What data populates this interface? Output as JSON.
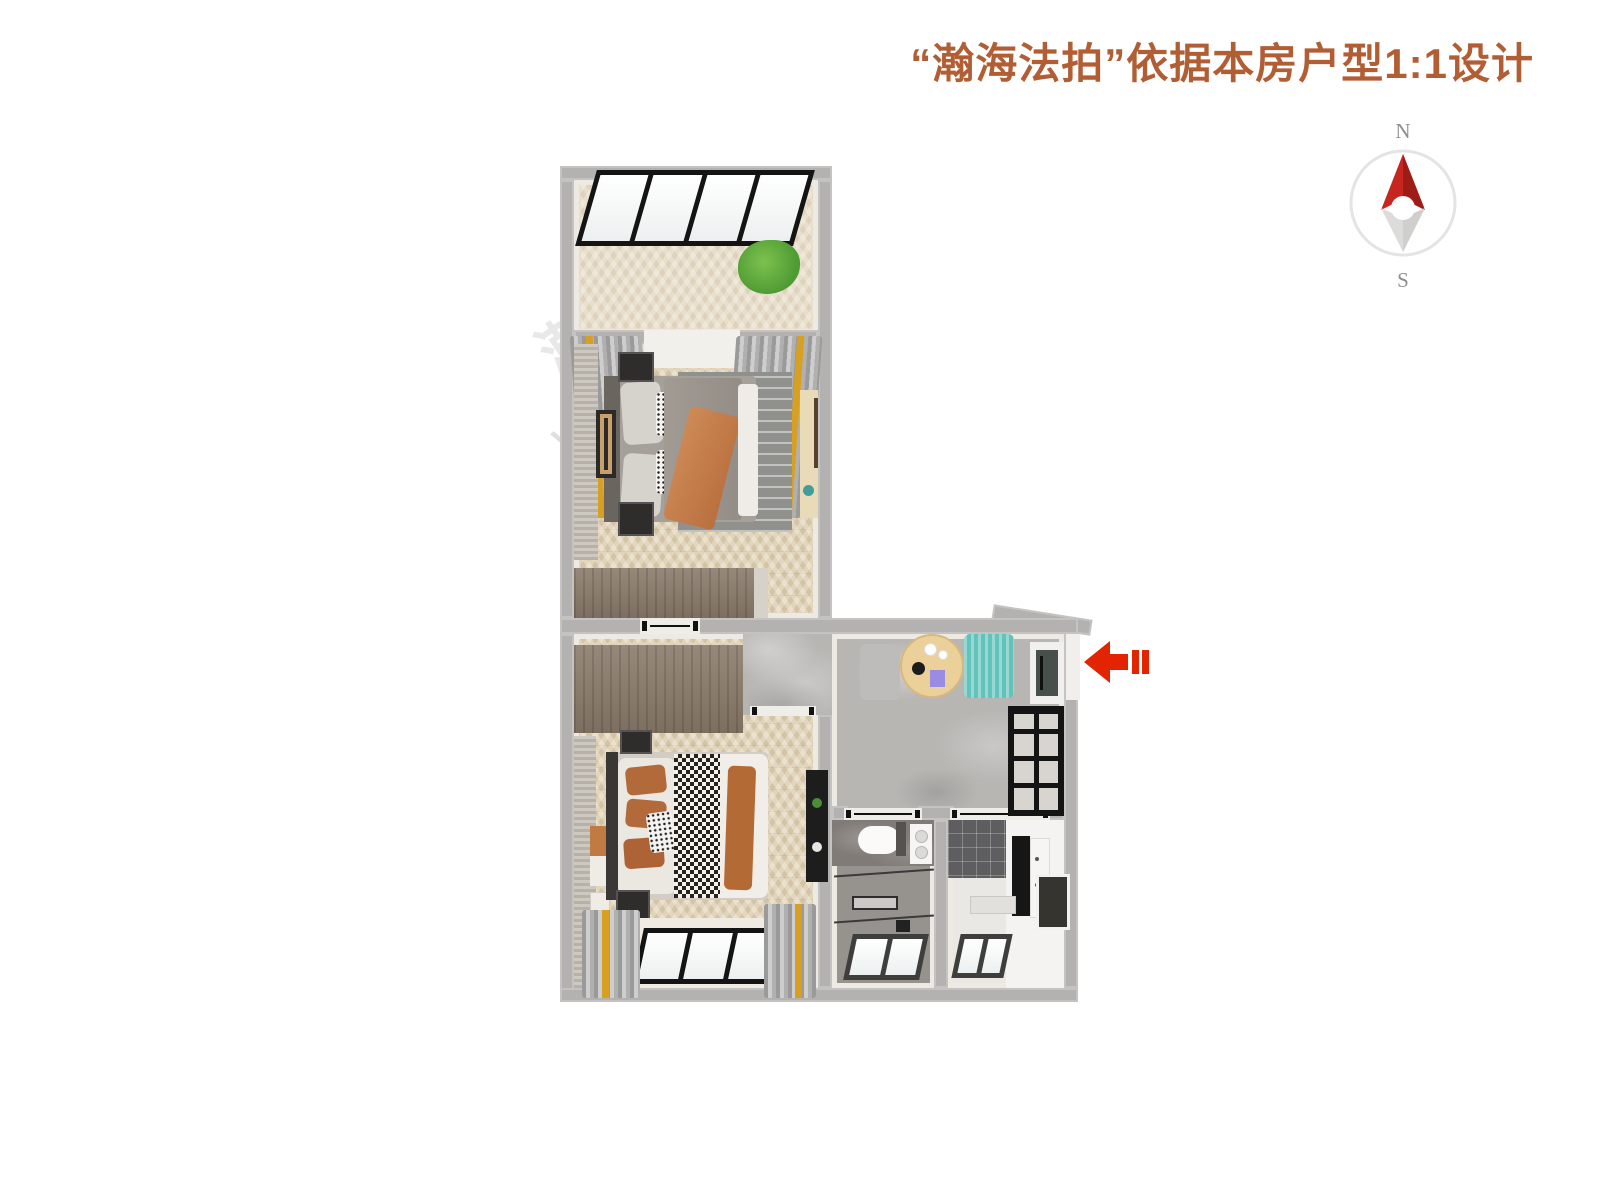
{
  "page": {
    "background": "#ffffff"
  },
  "header": {
    "title": "“瀚海法拍”依据本房户型1:1设计",
    "title_color": "#b25e35"
  },
  "compass": {
    "north_label": "N",
    "south_label": "S",
    "colors": {
      "needle_north": "#c6261f",
      "needle_north_shade": "#9e1b16",
      "needle_south": "#dcdcda",
      "ring": "#e4e4e4",
      "labels": "#8f8f8f"
    }
  },
  "entrance_arrow": {
    "icon": "arrow-left",
    "color": "#e32400"
  },
  "watermarks": {
    "primary": "www.fanai.cn",
    "secondary": "瀚海法拍"
  },
  "floor_plan": {
    "wall_color": "#b4b2b0",
    "rooms": [
      {
        "id": "balcony",
        "floor_color": "#e9dfca"
      },
      {
        "id": "bedroom-north",
        "floor_color": "#e2d4b8"
      },
      {
        "id": "bedroom-south",
        "floor_color": "#e2d4b8"
      },
      {
        "id": "hallway-dining",
        "floor_color": "#b8b6b3"
      },
      {
        "id": "bathroom",
        "floor_color": "#96938f"
      },
      {
        "id": "kitchen",
        "floor_color": "#eae8e5"
      }
    ],
    "accents": {
      "bed_throw_orange": "#c5804e",
      "bed2_pillow_orange": "#b26a3b",
      "dining_chair_teal": "#62c2bc",
      "dining_table_wood": "#ecd09a",
      "curtain_gold": "#d7a023",
      "plant_green": "#55a23b",
      "wardrobe_wood": "#8b7b6b"
    }
  }
}
